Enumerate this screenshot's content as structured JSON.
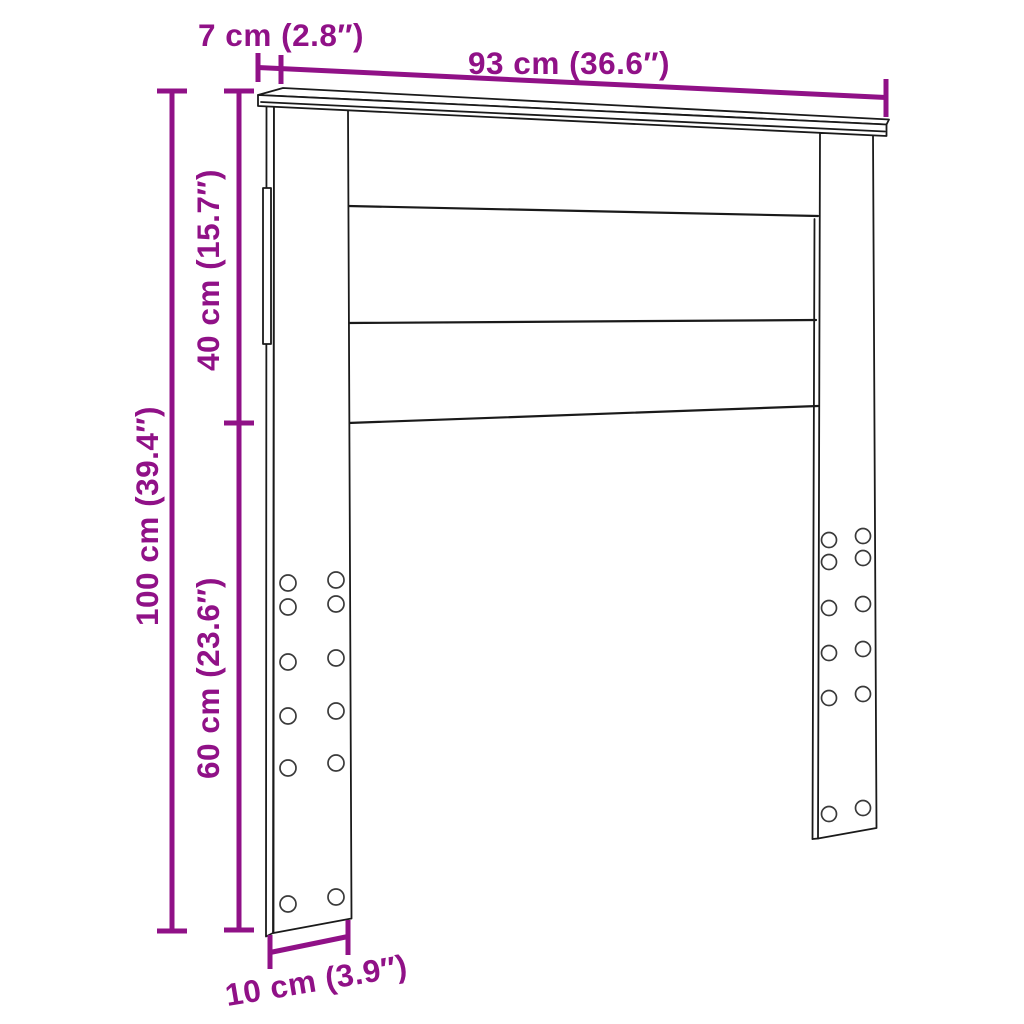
{
  "diagram": {
    "subject": "headboard-dimension-drawing",
    "colors": {
      "dimension_accent": "#901187",
      "drawing_outline": "#1a1a1a",
      "background": "#ffffff"
    },
    "labels": {
      "top_depth": "7 cm (2.8″)",
      "total_width": "93 cm (36.6″)",
      "upper_section_height": "40 cm (15.7″)",
      "total_height": "100 cm (39.4″)",
      "leg_section_height": "60 cm (23.6″)",
      "leg_depth": "10 cm (3.9″)"
    },
    "measurements": [
      {
        "name": "top rail depth",
        "cm": 7,
        "inches": 2.8
      },
      {
        "name": "total width",
        "cm": 93,
        "inches": 36.6
      },
      {
        "name": "upper panel height",
        "cm": 40,
        "inches": 15.7
      },
      {
        "name": "total height",
        "cm": 100,
        "inches": 39.4
      },
      {
        "name": "leg height",
        "cm": 60,
        "inches": 23.6
      },
      {
        "name": "leg depth",
        "cm": 10,
        "inches": 3.9
      }
    ]
  }
}
